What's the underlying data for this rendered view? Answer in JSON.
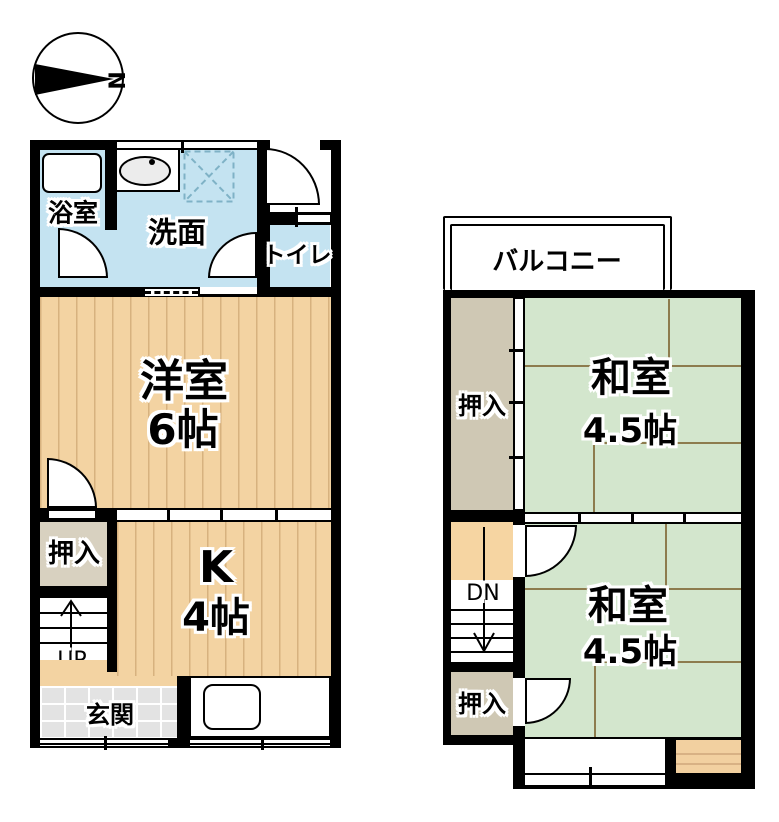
{
  "compass": {
    "north": "N"
  },
  "colors": {
    "wall": "#000000",
    "wet_room": "#c4e3f1",
    "wood_floor": "#f3d3a2",
    "tatami": "#d3e6cd",
    "tatami_line": "#8d7c4e",
    "closet_1f": "#d8d1c0",
    "closet_2f": "#cfc8b4",
    "stair_landing": "#f6d5a2",
    "entrance_tile": "#e3e3e3"
  },
  "floor1": {
    "bath": "浴室",
    "washroom": "洗面",
    "toilet": "トイレ",
    "western_room": "洋室",
    "western_room_size": "6帖",
    "closet": "押入",
    "kitchen": "K",
    "kitchen_size": "4帖",
    "stairs_up": "UP",
    "entrance": "玄関"
  },
  "floor2": {
    "balcony": "バルコニー",
    "closet_upper": "押入",
    "closet_lower": "押入",
    "room_upper": "和室",
    "room_upper_size": "4.5帖",
    "room_lower": "和室",
    "room_lower_size": "4.5帖",
    "stairs_down": "DN"
  }
}
